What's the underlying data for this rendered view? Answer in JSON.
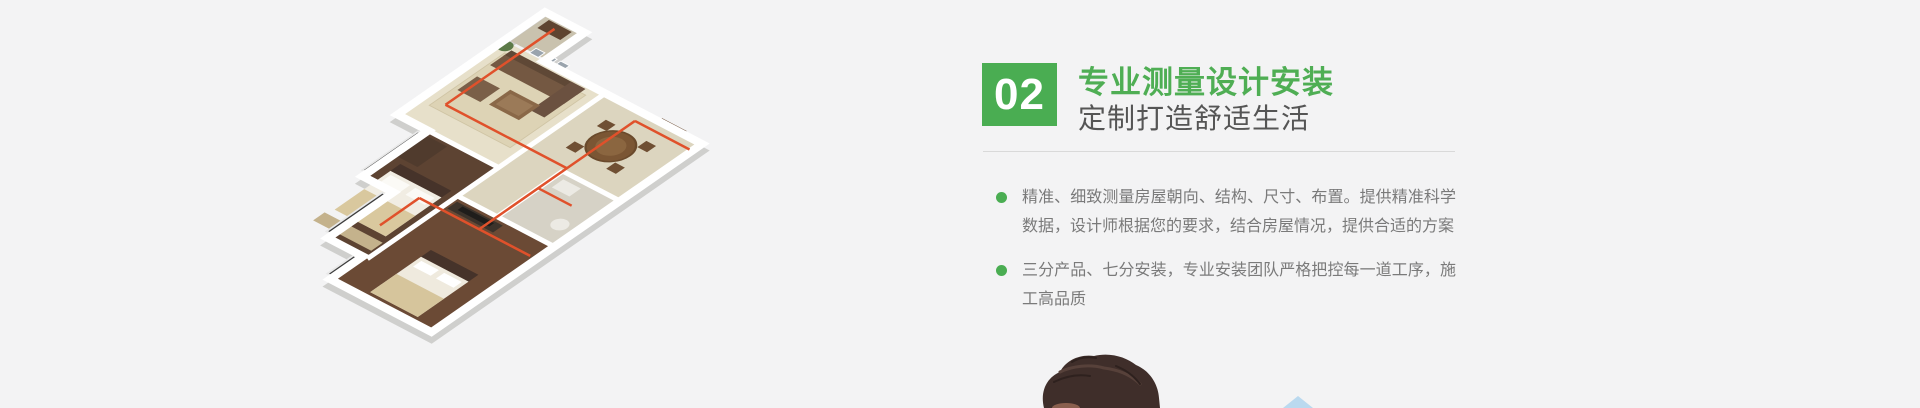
{
  "page": {
    "background_color": "#f3f3f4"
  },
  "step_section": {
    "badge": {
      "number": "02"
    },
    "title": "专业测量设计安装",
    "subtitle": "定制打造舒适生活",
    "bullets": [
      {
        "text": "精准、细致测量房屋朝向、结构、尺寸、布置。提供精准科学数据，设计师根据您的要求，结合房屋情况，提供合适的方案"
      },
      {
        "text": "三分产品、七分安装，专业安装团队严格把控每一道工序，施工高品质"
      }
    ],
    "colors": {
      "accent_green": "#4aad52",
      "title_green": "#4fae54",
      "subtitle_gray": "#555555",
      "body_gray": "#7a7a7a",
      "divider_gray": "#d9d9d9"
    }
  },
  "illustration": {
    "description": "isometric 3D apartment floor plan with red heating pipes",
    "pipe_color": "#e0512b",
    "wall_color": "#ffffff"
  },
  "photo_teaser": {
    "description": "top of a person's head entering from bottom edge",
    "hair_color": "#3f2e2a"
  },
  "decor": {
    "roof_triangle_color": "#bad9ef"
  }
}
